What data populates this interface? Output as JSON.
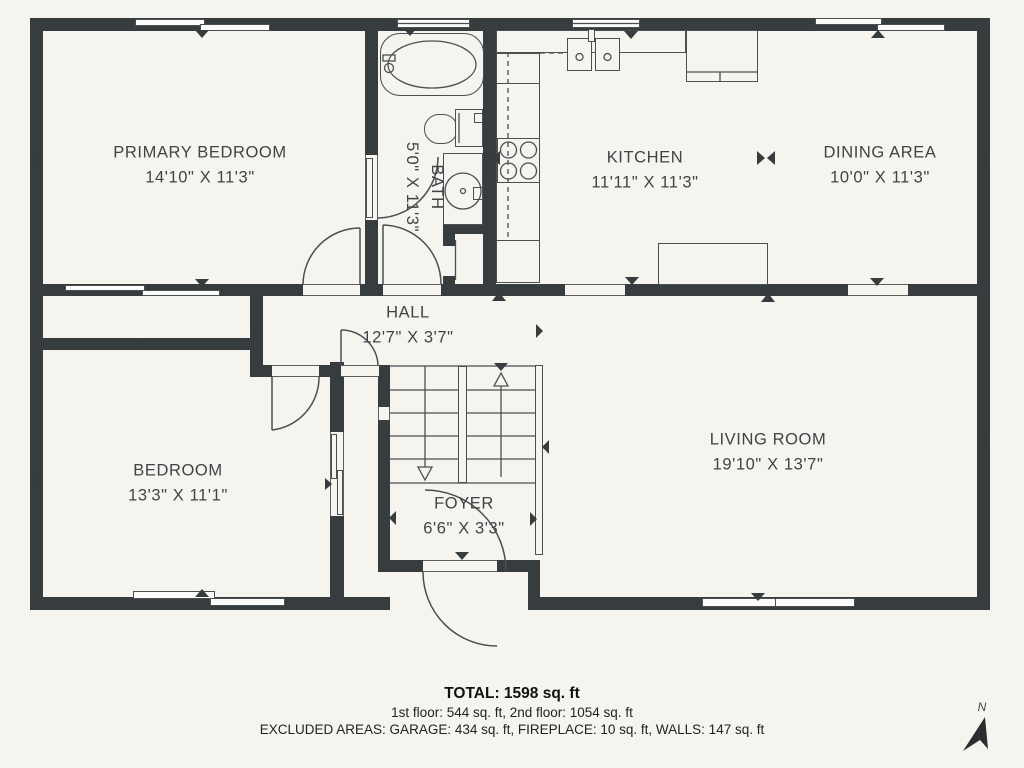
{
  "floorplan": {
    "rooms": [
      {
        "name": "PRIMARY BEDROOM",
        "dims": "14'10\" X 11'3\""
      },
      {
        "name": "BATH",
        "dims": "5'0\" X 11'3\""
      },
      {
        "name": "KITCHEN",
        "dims": "11'11\" X 11'3\""
      },
      {
        "name": "DINING AREA",
        "dims": "10'0\" X 11'3\""
      },
      {
        "name": "HALL",
        "dims": "12'7\" X 3'7\""
      },
      {
        "name": "BEDROOM",
        "dims": "13'3\" X 11'1\""
      },
      {
        "name": "LIVING ROOM",
        "dims": "19'10\" X 13'7\""
      },
      {
        "name": "FOYER",
        "dims": "6'6\" X 3'3\""
      }
    ],
    "footer": {
      "total": "TOTAL: 1598 sq. ft",
      "floors": "1st floor: 544 sq. ft, 2nd floor: 1054 sq. ft",
      "excluded": "EXCLUDED AREAS: GARAGE: 434 sq. ft, FIREPLACE: 10 sq. ft, WALLS: 147 sq. ft"
    },
    "compass": {
      "label": "N"
    },
    "fixtures": [
      "bathtub",
      "toilet",
      "sink-vanity",
      "kitchen-sink",
      "stove",
      "refrigerator",
      "dining-table",
      "staircase",
      "compass-north-icon"
    ],
    "colors": {
      "wall": "#373C3F",
      "background": "#F5F4EE",
      "line": "#4A4F52",
      "text": "#3F4449"
    }
  }
}
